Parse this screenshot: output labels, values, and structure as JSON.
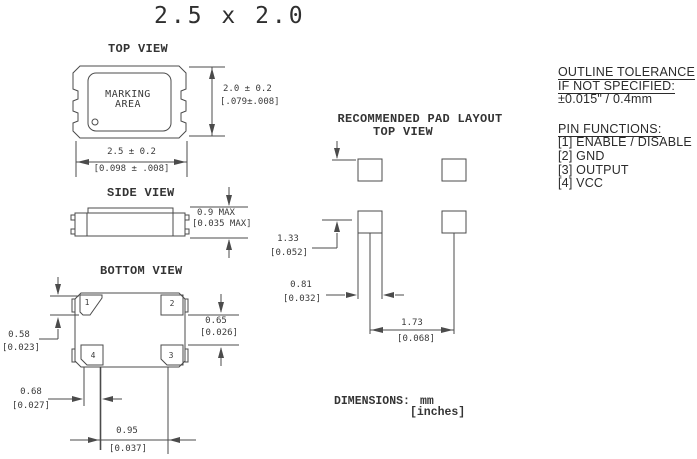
{
  "title": "2.5 x 2.0",
  "top_view": {
    "label": "TOP VIEW",
    "marking_area_line1": "MARKING",
    "marking_area_line2": "AREA",
    "height_mm": "2.0 ± 0.2",
    "height_in": "[.079±.008]",
    "width_mm": "2.5 ± 0.2",
    "width_in": "[0.098 ± .008]"
  },
  "side_view": {
    "label": "SIDE VIEW",
    "height_mm": "0.9 MAX",
    "height_in": "[0.035 MAX]"
  },
  "bottom_view": {
    "label": "BOTTOM VIEW",
    "pad1": "1",
    "pad2": "2",
    "pad3": "3",
    "pad4": "4",
    "pad_height_mm": "0.58",
    "pad_height_in": "[0.023]",
    "pad_gap_mm": "0.65",
    "pad_gap_in": "[0.026]",
    "pad_width_mm": "0.68",
    "pad_width_in": "[0.027]",
    "pad_pitch_mm": "0.95",
    "pad_pitch_in": "[0.037]"
  },
  "pad_layout": {
    "label_line1": "RECOMMENDED PAD LAYOUT",
    "label_line2": "TOP VIEW",
    "row_offset_mm": "1.33",
    "row_offset_in": "[0.052]",
    "pad_width_mm": "0.81",
    "pad_width_in": "[0.032]",
    "pad_pitch_mm": "1.73",
    "pad_pitch_in": "[0.068]"
  },
  "notes": {
    "dimensions_label": "DIMENSIONS:",
    "unit_primary": "mm",
    "unit_secondary": "[inches]"
  },
  "side_panel": {
    "tolerance_heading_line1": "OUTLINE TOLERANCE",
    "tolerance_heading_line2": "IF NOT SPECIFIED:",
    "tolerance_value": "±0.015\" / 0.4mm",
    "pin_functions_heading": "PIN FUNCTIONS:",
    "pin_functions": [
      "[1] ENABLE / DISABLE",
      "[2] GND",
      "[3] OUTPUT",
      "[4] VCC"
    ]
  },
  "colors": {
    "line": "#4b4b4b",
    "text": "#3a3a3a",
    "panel_text": "#2b2b2b",
    "background": "#ffffff"
  }
}
